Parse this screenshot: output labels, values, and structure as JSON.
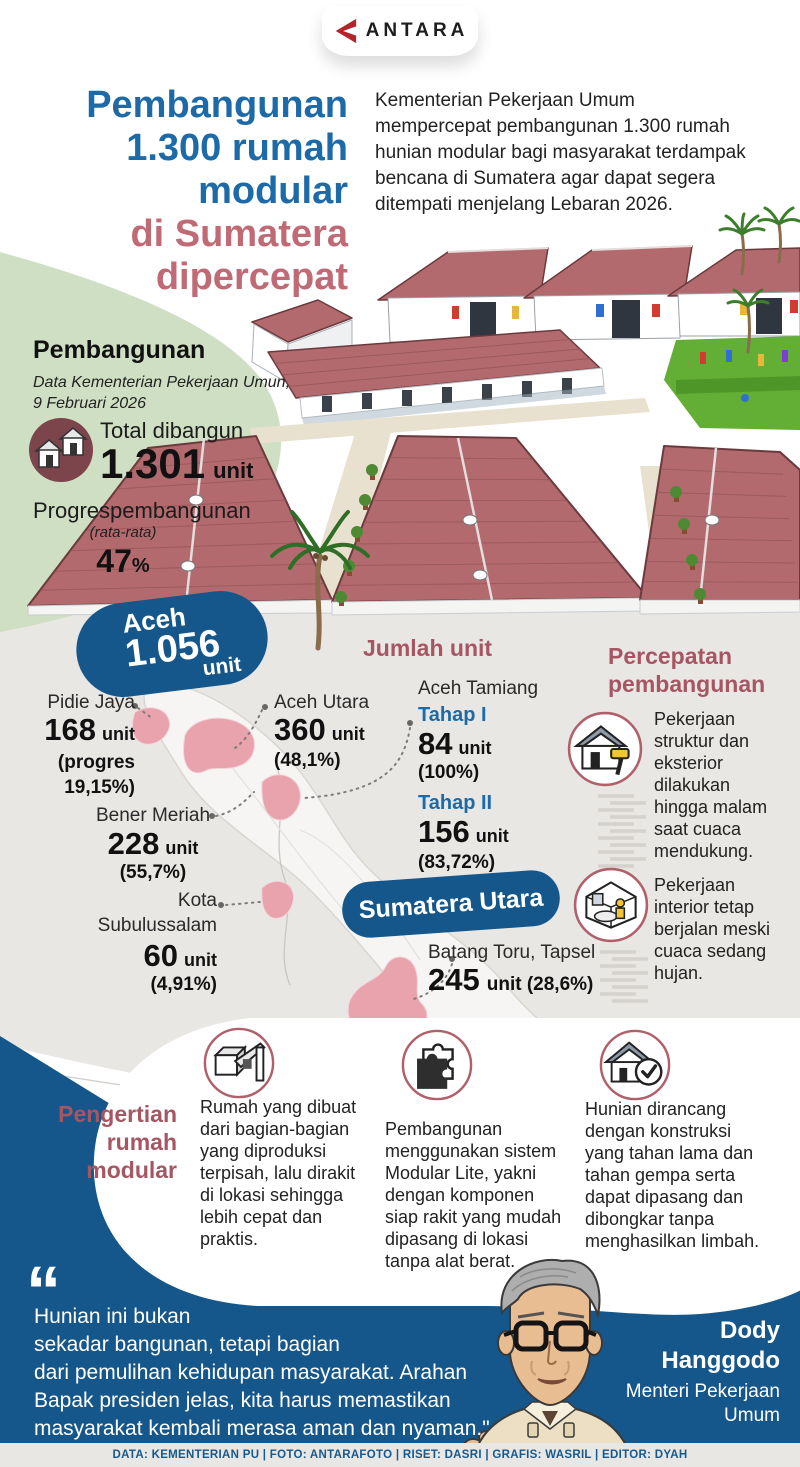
{
  "brand": {
    "logo_text": "ANTARA"
  },
  "title": {
    "blue": "Pembangunan\n1.300 rumah\nmodular",
    "rose": "di Sumatera\ndipercepat"
  },
  "intro": "Kementerian Pekerjaan Umum mempercepat pembangunan 1.300 rumah hunian modular bagi masyarakat terdampak bencana di Sumatera agar dapat segera ditempati menjelang Lebaran 2026.",
  "pembangunan": {
    "heading": "Pembangunan",
    "source": "Data Kementerian Pekerjaan Umun,\n9 Februari 2026",
    "total_label": "Total dibangun",
    "total_value": "1.301",
    "total_unit": "unit",
    "progress_label": "Progrespembangunan",
    "progress_sublabel": "(rata-rata)",
    "progress_value": "47",
    "progress_pct": "%"
  },
  "aceh_pill": {
    "name": "Aceh",
    "value": "1.056",
    "unit": "unit"
  },
  "jumlah_unit_heading": "Jumlah unit",
  "sumatera_utara_label": "Sumatera Utara",
  "regions": {
    "pidie_jaya": {
      "name": "Pidie Jaya",
      "value": "168",
      "unit": "unit",
      "detail": "(progres\n19,15%)"
    },
    "aceh_utara": {
      "name": "Aceh Utara",
      "value": "360",
      "unit": "unit",
      "detail": "(48,1%)"
    },
    "bener_meriah": {
      "name": "Bener Meriah",
      "value": "228",
      "unit": "unit",
      "detail": "(55,7%)"
    },
    "kota_subulussalam": {
      "name": "Kota\nSubulussalam",
      "value": "60",
      "unit": "unit",
      "detail": "(4,91%)"
    },
    "aceh_tamiang": {
      "name": "Aceh Tamiang",
      "tahap1_label": "Tahap I",
      "tahap1_value": "84",
      "tahap1_unit": "unit",
      "tahap1_detail": "(100%)",
      "tahap2_label": "Tahap II",
      "tahap2_value": "156",
      "tahap2_unit": "unit",
      "tahap2_detail": "(83,72%)"
    },
    "batang_toru": {
      "name": "Batang Toru, Tapsel",
      "value": "245",
      "detail": "unit (28,6%)"
    }
  },
  "percepatan": {
    "heading": "Percepatan\npembangunan",
    "items": [
      {
        "icon": "house-paint-roller-icon",
        "text": "Pekerjaan struktur dan eksterior dilakukan hingga malam saat cuaca mendukung."
      },
      {
        "icon": "room-interior-icon",
        "text": "Pekerjaan interior tetap berjalan meski cuaca sedang hujan."
      }
    ]
  },
  "pengertian": {
    "heading": "Pengertian\nrumah\nmodular",
    "items": [
      {
        "icon": "modular-assembly-icon",
        "text": "Rumah yang dibuat dari bagian-bagian yang diproduksi terpisah, lalu dirakit di lokasi sehingga lebih cepat dan praktis."
      },
      {
        "icon": "puzzle-piece-icon",
        "text": "Pembangunan menggunakan sistem Modular Lite, yakni dengan komponen siap rakit yang mudah dipasang di lokasi tanpa alat berat."
      },
      {
        "icon": "house-check-icon",
        "text": "Hunian dirancang dengan konstruksi yang tahan lama dan tahan gempa serta dapat dipasang dan dibongkar tanpa menghasilkan limbah."
      }
    ]
  },
  "quote": {
    "mark": "“",
    "text": "Hunian ini bukan\nsekadar bangunan, tetapi bagian\ndari pemulihan kehidupan masyarakat. Arahan\nBapak presiden jelas, kita harus memastikan\nmasyarakat kembali merasa aman dan nyaman.\"",
    "person_name": "Dody\nHanggodo",
    "person_title": "Menteri Pekerjaan\nUmum"
  },
  "footer": {
    "credits": "DATA: KEMENTERIAN PU    |    FOTO: ANTARAFOTO    |    RISET: DASRI    |    GRAFIS: WASRIL    |    EDITOR: DYAH"
  },
  "colors": {
    "title_blue": "#1d6aa8",
    "title_rose": "#c06a75",
    "accent_maroon": "#a65662",
    "pill_blue": "#15578b",
    "map_pink": "#e8a3ad",
    "green_wedge": "#cfdfc3",
    "gray_bg": "#e9e7e4",
    "roof_red": "#b26a6e",
    "footer_text": "#16598e"
  }
}
